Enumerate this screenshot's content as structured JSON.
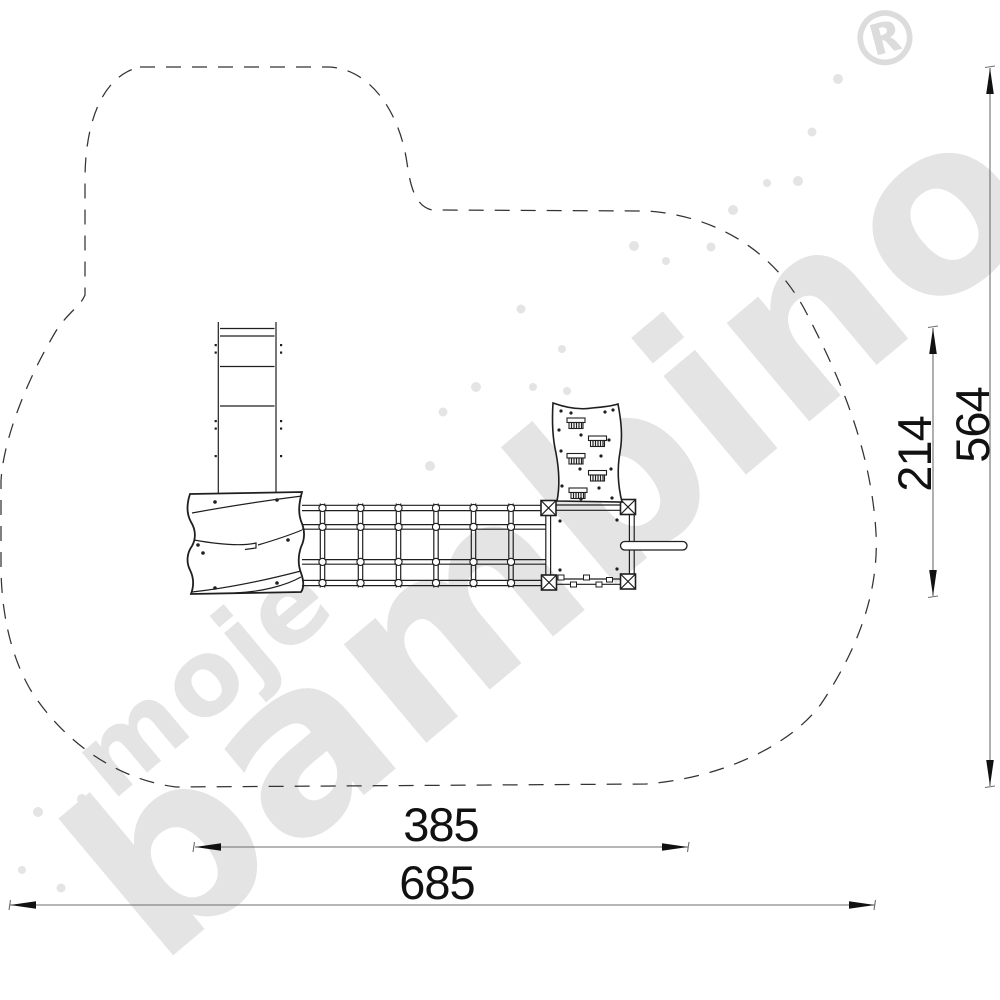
{
  "watermark": {
    "word1": "moje",
    "word2": "bambino",
    "registered_mark": "®",
    "color": "#e4e4e4"
  },
  "dimensions": {
    "inner_width": {
      "label": "385"
    },
    "outer_width": {
      "label": "685"
    },
    "inner_height": {
      "label": "214"
    },
    "outer_height": {
      "label": "564"
    }
  },
  "colors": {
    "background": "#ffffff",
    "equipment_line": "#1f1f1f",
    "safety_zone_line": "#333333",
    "dimension_line": "#6e6e6e",
    "dimension_text": "#111111",
    "watermark": "#e4e4e4"
  }
}
